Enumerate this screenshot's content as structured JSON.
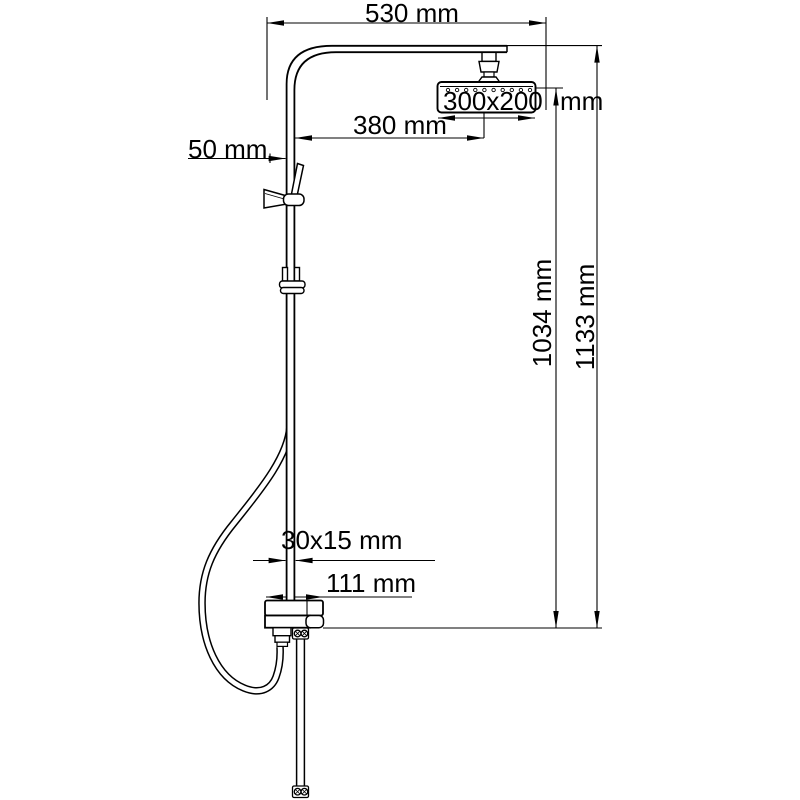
{
  "colors": {
    "line": "#000000",
    "background": "#ffffff"
  },
  "labels": {
    "top_width": "530 mm",
    "head_size": "300x200 mm",
    "arm_reach": "380 mm",
    "holder_offset": "50 mm",
    "height_to_head": "1034 mm",
    "total_height": "1133 mm",
    "riser_section": "30x15 mm",
    "mixer_width": "111 mm"
  }
}
